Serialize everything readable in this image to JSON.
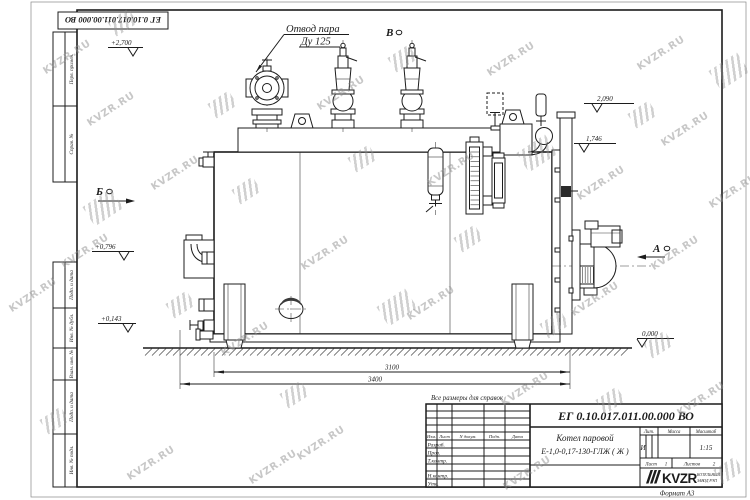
{
  "watermark": {
    "text": "KVZR.RU"
  },
  "corner_stamp": {
    "doc_number": "ЕГ 0.10.017.011.00.000  ВО"
  },
  "margin_fields": {
    "f1": "Перв. примен.",
    "f2": "Справ. №",
    "f3": "Подп. и дата",
    "f4": "Инв. № дубл.",
    "f5": "Взам. инв. №",
    "f6": "Подп. и дата",
    "f7": "Инв. № подл."
  },
  "drawing": {
    "note": "Все размеры для справок",
    "callout": {
      "line1": "Отвод пара",
      "line2": "Ду 125"
    },
    "views": {
      "a": "А",
      "b": "Б",
      "v": "В"
    },
    "elevations": {
      "e2700": "+2,700",
      "e2090": "2,090",
      "e1746": "1,746",
      "e0796": "+0,796",
      "e0143": "+0,143",
      "e0000": "0,000"
    },
    "dims": {
      "d3100": "3100",
      "d3400": "3400"
    }
  },
  "title_block": {
    "doc_number": "ЕГ 0.10.017.011.00.000  ВО",
    "name_line1": "Котел паровой",
    "name_line2": "Е-1,0-0,17-130-ГЛЖ ( Ж )",
    "col_izm": "Изм.",
    "col_list": "Лист",
    "col_ndoc": "N докум.",
    "col_podp": "Подп.",
    "col_data": "Дата",
    "row_razrab": "Разраб.",
    "row_prov": "Пров.",
    "row_tkontr": "Т.контр.",
    "row_nkontr": "Н.контр.",
    "row_utv": "Утв.",
    "lit_label": "Лит.",
    "lit_value": "И",
    "mass_label": "Масса",
    "scale_label": "Масштаб",
    "scale_value": "1:15",
    "sheet_label": "Лист",
    "sheet_value": "1",
    "sheets_label": "Листов",
    "sheets_value": "2",
    "company_name": "KVZR",
    "company_sub1": "КОТЕЛЬНЫЙ",
    "company_sub2": "ЗАВОД РЭП",
    "format_label": "Формат А3"
  }
}
